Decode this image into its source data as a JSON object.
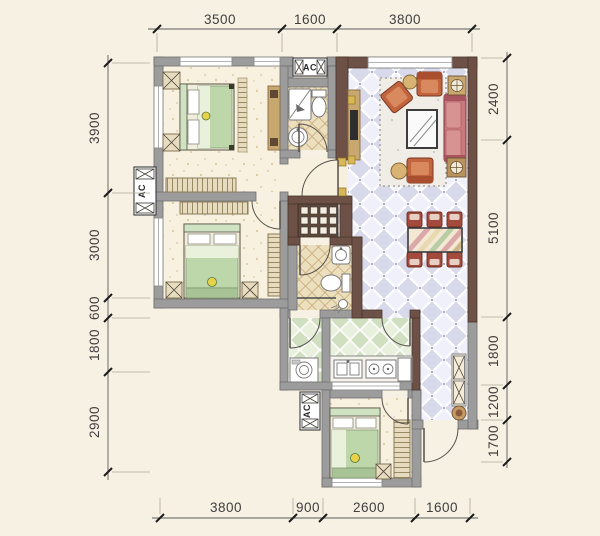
{
  "labels": {
    "ac": "AC"
  },
  "dimensions": {
    "top": [
      "3500",
      "1600",
      "3800"
    ],
    "left": [
      "3900",
      "3000",
      "600",
      "1800",
      "2900"
    ],
    "right": [
      "2400",
      "5100",
      "1800",
      "1200",
      "1700"
    ],
    "bottom": [
      "3800",
      "900",
      "2600",
      "1600"
    ]
  },
  "colors": {
    "background": "#f7f1e3",
    "wall_gray": "#9c9c9c",
    "wall_dark_marble": "#6d5146",
    "tile_living_lavender": "#e3e3f2",
    "tile_kitchen_green": "#dfe9d2",
    "tile_bath_tan": "#ecdfbe",
    "floor_bedroom_cream": "#f8f1df",
    "bed_green": "#bdd6aa",
    "sofa_rose": "#c97a7a",
    "armchair_terracotta": "#c2653f",
    "dining_chair_maroon": "#a34a3c",
    "wood": "#c9a870",
    "dimension_text": "#3f3f3f"
  }
}
